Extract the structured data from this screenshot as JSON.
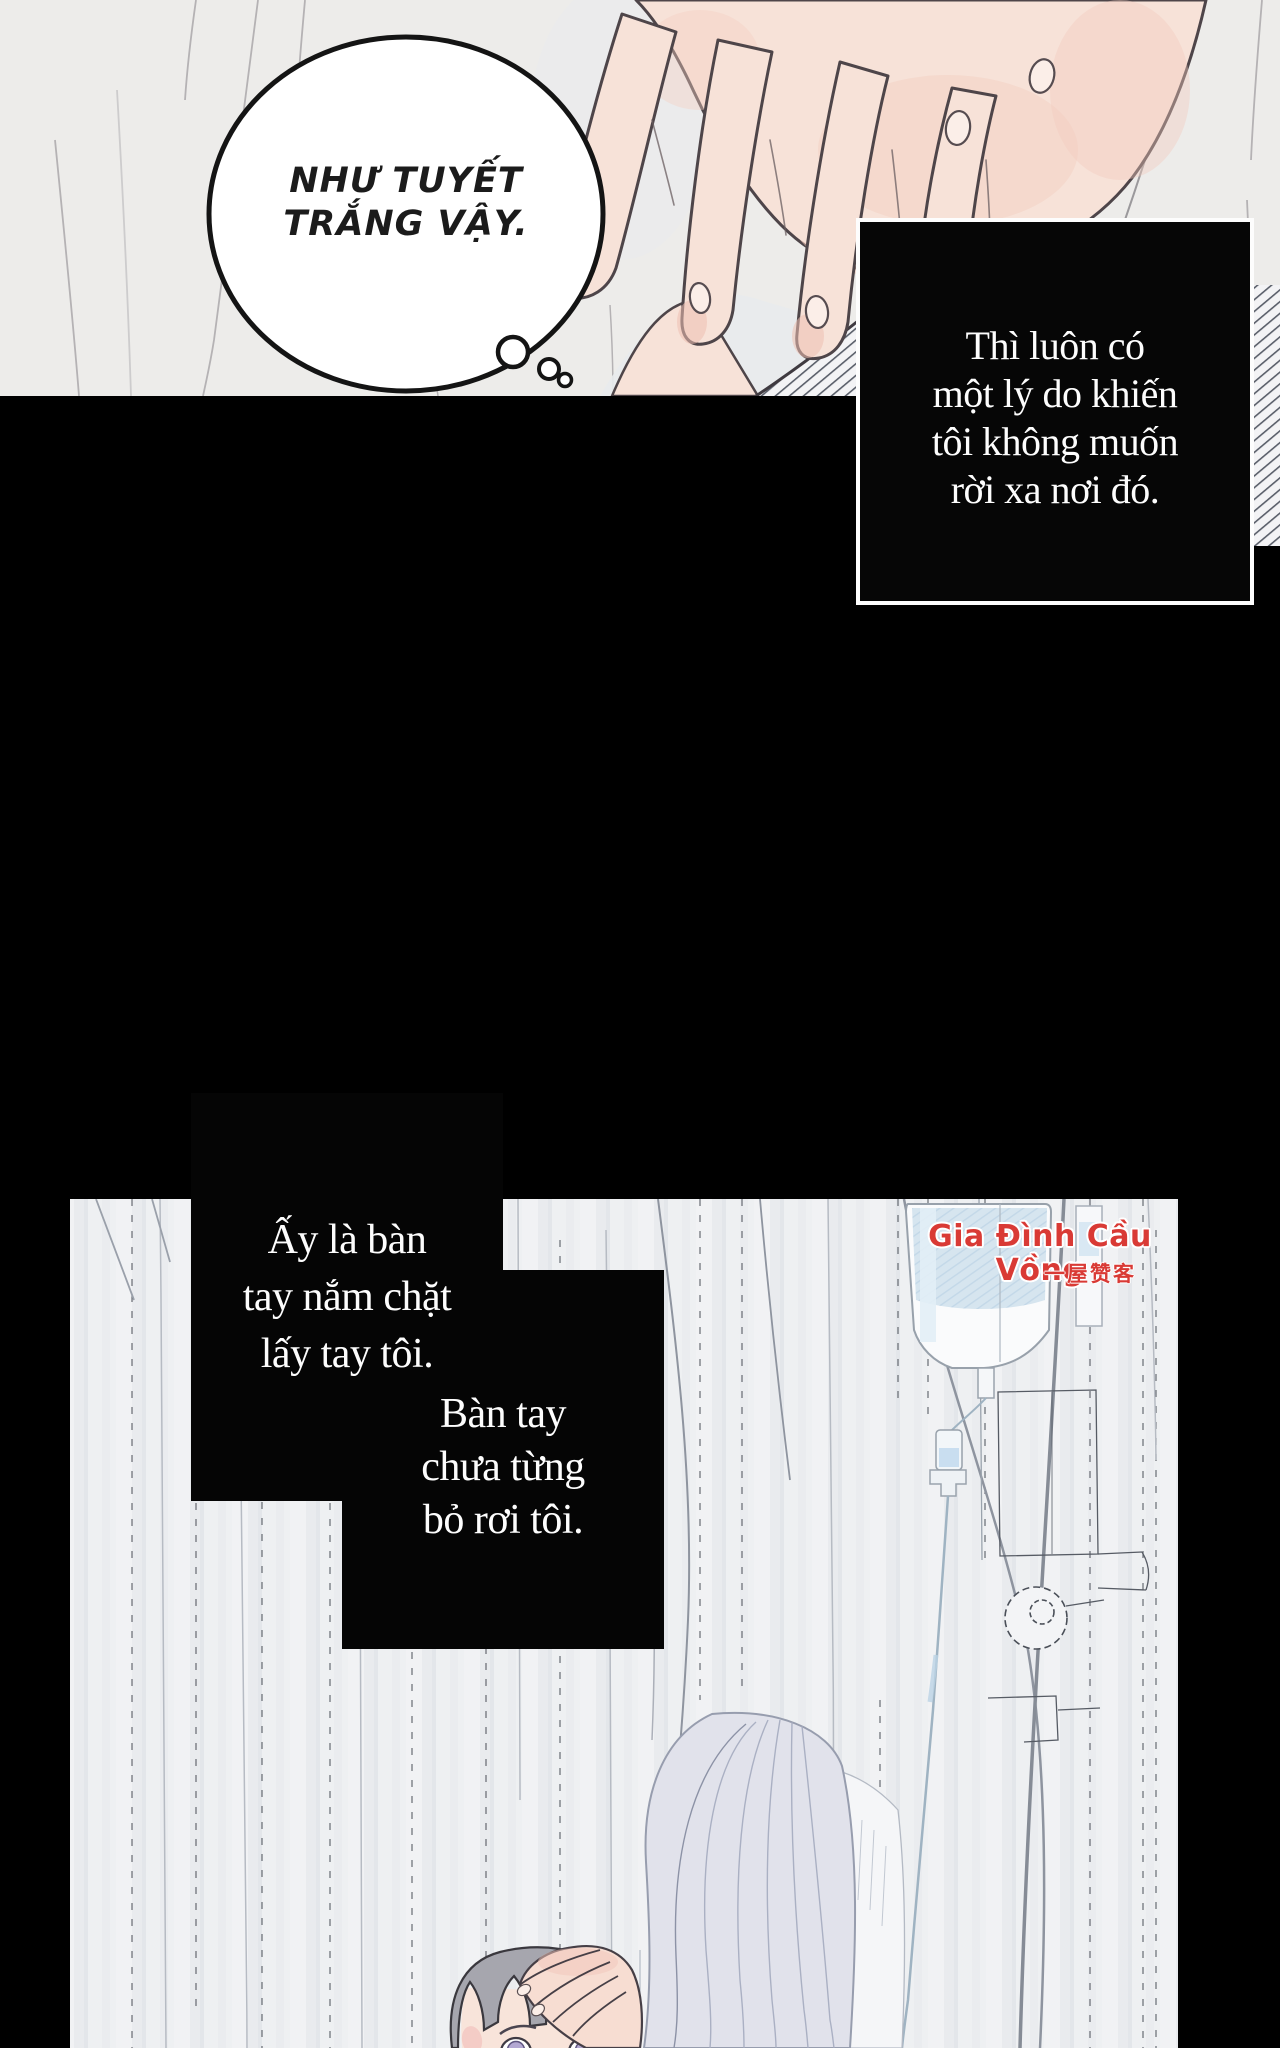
{
  "comic": {
    "thought_bubble": {
      "line1": "NHƯ TUYẾT",
      "line2": "TRẮNG VẬY."
    },
    "narration": {
      "box1": {
        "line1": "Thì luôn có",
        "line2": "một lý do khiến",
        "line3": "tôi không muốn",
        "line4": "rời xa nơi đó."
      },
      "box2": {
        "line1": "Ấy là bàn",
        "line2": "tay nắm chặt",
        "line3": "lấy tay tôi."
      },
      "box3": {
        "line1": "Bàn tay",
        "line2": "chưa từng",
        "line3": "bỏ rơi tôi."
      }
    },
    "watermark": {
      "title": "Gia Đình Cầu Vồng",
      "subtitle": "一屋赞客",
      "color": "#d93a35"
    },
    "colors": {
      "page_bg": "#000000",
      "panel1_bg": "#edecea",
      "curtain_bg": "#eef0f2",
      "skin": "#f7e2d8",
      "iv_blue": "#d6e5ef",
      "hair_lavender": "#e1e2eb",
      "caption_text": "#fdfdfd"
    }
  }
}
